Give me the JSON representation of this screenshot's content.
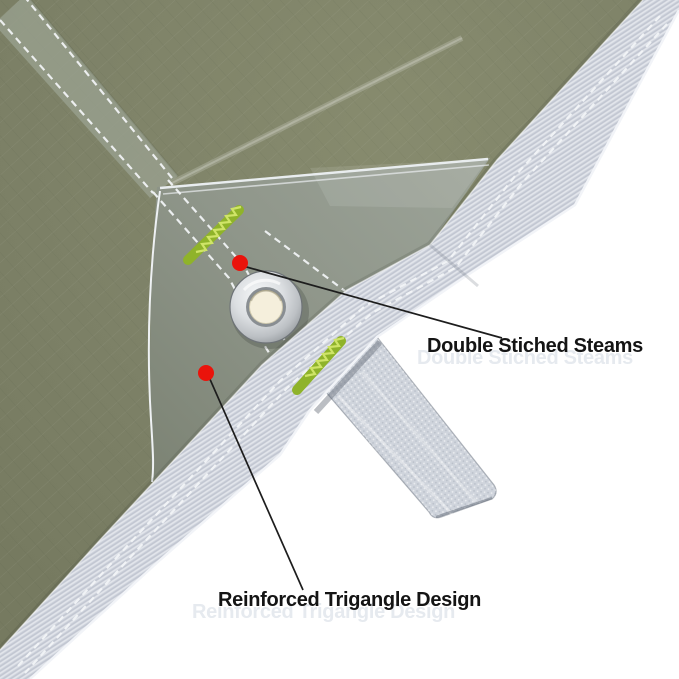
{
  "image": {
    "labels": [
      {
        "text": "Double Stiched Steams"
      },
      {
        "text": "Reinforced Trigangle Design"
      }
    ],
    "colors": {
      "background": "#ffffff",
      "tarp_fabric": "#7d8167",
      "corner_patch": "#8f968a",
      "binding_tape": "#cbd0da",
      "webbing": "#cfd4dc",
      "stitch_green": "#a5cc35",
      "stitch_green_light": "#cfe468",
      "stitch_green_dark": "#8fb32a",
      "stitch_white": "#f3f5f7",
      "marker_red": "#ea130b",
      "grommet_hole": "#f5efdc",
      "label_text": "#141414",
      "watermark": "#e6eaef"
    }
  }
}
